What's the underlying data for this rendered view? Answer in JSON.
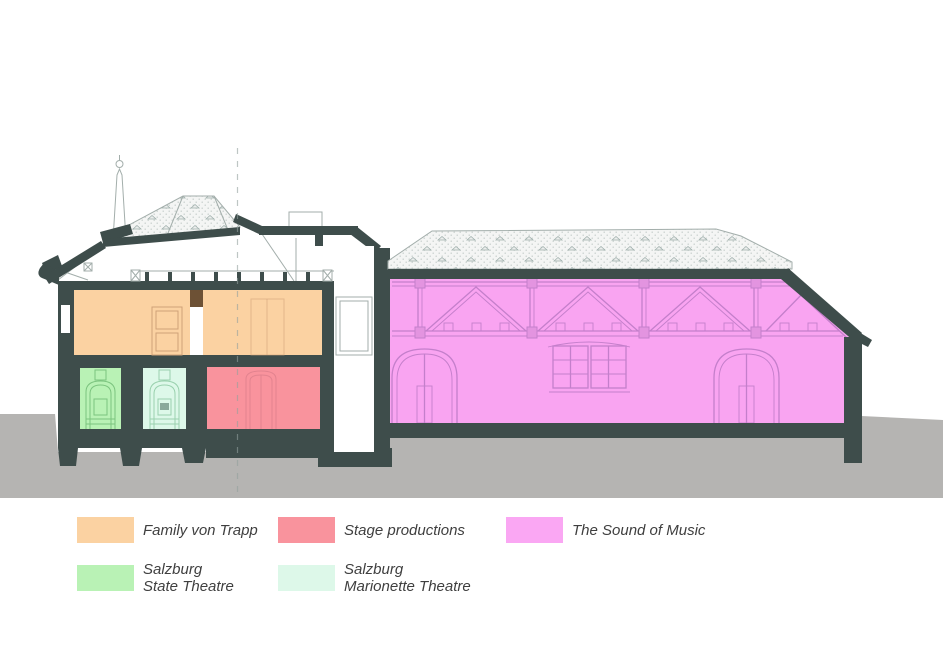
{
  "legend": {
    "items": [
      {
        "id": "family-von-trapp",
        "color": "#FBD2A2",
        "lines": [
          "Family von Trapp"
        ]
      },
      {
        "id": "stage-productions",
        "color": "#F9939D",
        "lines": [
          "Stage productions"
        ]
      },
      {
        "id": "the-sound-of-music",
        "color": "#FAA7F3",
        "lines": [
          "The Sound of Music"
        ]
      },
      {
        "id": "salzburg-state-theatre",
        "color": "#B9F2B5",
        "lines": [
          "Salzburg",
          "State Theatre"
        ]
      },
      {
        "id": "salzburg-marionette-theatre",
        "color": "#DDF8E9",
        "lines": [
          "Salzburg",
          "Marionette Theatre"
        ]
      }
    ]
  },
  "zones": {
    "family_von_trapp": {
      "color": "#FBD2A2"
    },
    "stage_productions": {
      "color": "#F9939D"
    },
    "sound_of_music": {
      "color": "#F9A4F1"
    },
    "state_theatre": {
      "color": "#B9F2B5"
    },
    "marionette_theatre": {
      "color": "#DDF8E9"
    }
  },
  "palette": {
    "wall-dark": "#3E4D4B",
    "ground-gray": "#B5B4B2",
    "roof-fill": "#F4F5F4",
    "roof-dot": "#C3CBC8",
    "line-light": "#A3AEAB",
    "truss-purple": "#C47FCB",
    "wood-brown": "#6D5135",
    "text-gray": "#3F3F3F"
  }
}
